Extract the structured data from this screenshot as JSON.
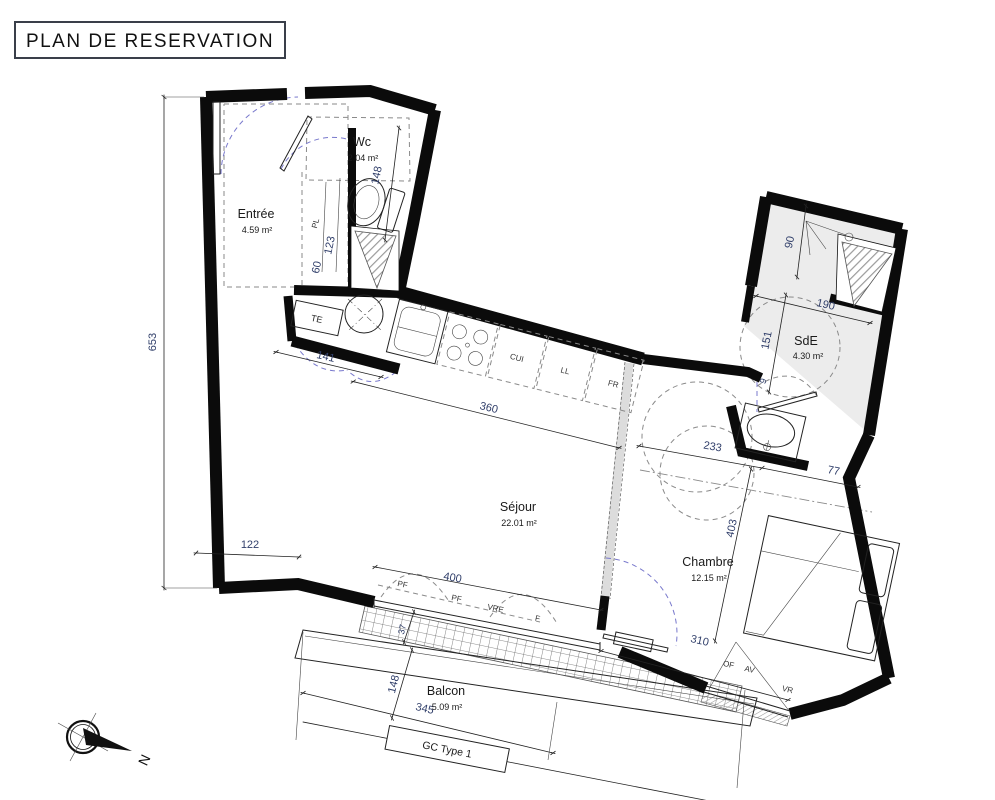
{
  "title": "PLAN DE RESERVATION",
  "compass": {
    "north": "N"
  },
  "rooms": {
    "wc": {
      "name": "Wc",
      "area": "2.04 m²"
    },
    "entree": {
      "name": "Entrée",
      "area": "4.59 m²"
    },
    "sejour": {
      "name": "Séjour",
      "area": "22.01 m²"
    },
    "chambre": {
      "name": "Chambre",
      "area": "12.15 m²"
    },
    "sde": {
      "name": "SdE",
      "area": "4.30 m²"
    },
    "balcon": {
      "name": "Balcon",
      "area": "5.09 m²"
    }
  },
  "fixtures": {
    "pl": "PL",
    "te": "TE",
    "cui": "CUI",
    "ll": "LL",
    "fr": "FR"
  },
  "openings": {
    "pf1": "PF",
    "pf2": "PF",
    "vre": "VRE",
    "f": "F",
    "of": "OF",
    "av": "AV",
    "vr": "VR"
  },
  "plan_type": {
    "label": "GC Type 1"
  },
  "dimensions": {
    "left_total": "653",
    "sejour_left": "122",
    "entree_hall": "141",
    "closet_width": "60",
    "closet_depth": "123",
    "wc_depth": "148",
    "kitchen_run": "360",
    "bay_width": "400",
    "bay_jamb": "37",
    "balcon_depth": "148",
    "balcon_width": "345",
    "chambre_width": "233",
    "chambre_to_wall": "77",
    "chambre_length": "403",
    "chambre_bay": "310",
    "sde_shower": "90",
    "sde_width": "190",
    "sde_depth": "151",
    "sde_door_offset": "9"
  },
  "colors": {
    "wall": "#0b0b0b",
    "dimension_text": "#32406b",
    "door_arc": "#7878cc",
    "dashed_gray": "#8a8a8a",
    "room_fill": "#ececec",
    "hatch": "#9a9a9a"
  }
}
